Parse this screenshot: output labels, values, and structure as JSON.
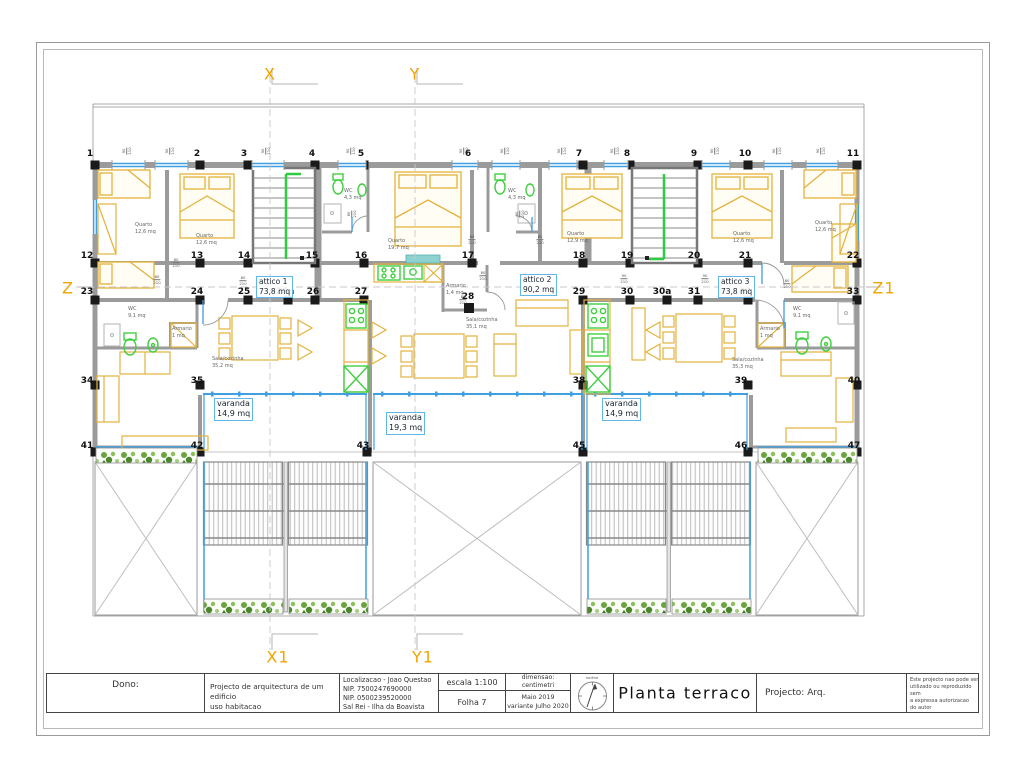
{
  "title_block": {
    "dono_label": "Dono:",
    "project_description": "Projecto de arquitectura de um edificio\nuso habitacao",
    "localizacao": "Localizacao - Joao Questao\nNIP. 7500247690000\nNIP. 0500239520000\nSal Rei - Ilha da Boavista",
    "escala": "escala 1:100",
    "folha": "Folha 7",
    "dimensao": "dimensao: centimetri",
    "data_variante": "Maio  2019\nvariante Julho  2020",
    "north_label": "northe",
    "drawing_title": "Planta terraco",
    "projecto": "Projecto:  Arq.",
    "nota": "Este projecto nao pode ser\nutilizado ou reproduzido  sem\na expressa autorizacao\ndo autor"
  },
  "colors": {
    "axis_accent": "#f0a500",
    "furniture_yellow": "#e3b23c",
    "fixture_green": "#3fcf3f",
    "glazing_blue": "#3f9fe0",
    "label_box_border": "#5fb6e8",
    "wall_gray": "#9b9b9b",
    "stair_rail_green": "#2ecc40"
  },
  "plan": {
    "axis_labels": [
      {
        "label": "X",
        "x": 270,
        "y": 74
      },
      {
        "label": "Y",
        "x": 415,
        "y": 74
      },
      {
        "label": "X1",
        "x": 278,
        "y": 657
      },
      {
        "label": "Y1",
        "x": 423,
        "y": 657
      },
      {
        "label": "Z",
        "x": 68,
        "y": 288
      },
      {
        "label": "Z1",
        "x": 884,
        "y": 288
      }
    ],
    "grid_labels": [
      {
        "t": "1",
        "x": 90,
        "y": 154
      },
      {
        "t": "2",
        "x": 197,
        "y": 154
      },
      {
        "t": "3",
        "x": 244,
        "y": 154
      },
      {
        "t": "4",
        "x": 312,
        "y": 154
      },
      {
        "t": "5",
        "x": 361,
        "y": 154
      },
      {
        "t": "6",
        "x": 468,
        "y": 154
      },
      {
        "t": "7",
        "x": 579,
        "y": 154
      },
      {
        "t": "8",
        "x": 627,
        "y": 154
      },
      {
        "t": "9",
        "x": 694,
        "y": 154
      },
      {
        "t": "10",
        "x": 745,
        "y": 154
      },
      {
        "t": "11",
        "x": 853,
        "y": 154
      },
      {
        "t": "12",
        "x": 87,
        "y": 256
      },
      {
        "t": "13",
        "x": 197,
        "y": 256
      },
      {
        "t": "14",
        "x": 244,
        "y": 256
      },
      {
        "t": "15",
        "x": 312,
        "y": 256
      },
      {
        "t": "16",
        "x": 361,
        "y": 256
      },
      {
        "t": "17",
        "x": 468,
        "y": 256
      },
      {
        "t": "18",
        "x": 579,
        "y": 256
      },
      {
        "t": "19",
        "x": 627,
        "y": 256
      },
      {
        "t": "20",
        "x": 694,
        "y": 256
      },
      {
        "t": "21",
        "x": 745,
        "y": 256
      },
      {
        "t": "22",
        "x": 853,
        "y": 256
      },
      {
        "t": "23",
        "x": 87,
        "y": 292
      },
      {
        "t": "24",
        "x": 197,
        "y": 292
      },
      {
        "t": "25",
        "x": 244,
        "y": 292
      },
      {
        "t": "25a",
        "x": 285,
        "y": 292
      },
      {
        "t": "26",
        "x": 313,
        "y": 292
      },
      {
        "t": "27",
        "x": 361,
        "y": 292
      },
      {
        "t": "28",
        "x": 468,
        "y": 297
      },
      {
        "t": "29",
        "x": 579,
        "y": 292
      },
      {
        "t": "30",
        "x": 627,
        "y": 292
      },
      {
        "t": "30a",
        "x": 662,
        "y": 292
      },
      {
        "t": "31",
        "x": 694,
        "y": 292
      },
      {
        "t": "32",
        "x": 745,
        "y": 292
      },
      {
        "t": "33",
        "x": 853,
        "y": 292
      },
      {
        "t": "34",
        "x": 87,
        "y": 381
      },
      {
        "t": "35",
        "x": 197,
        "y": 381
      },
      {
        "t": "38",
        "x": 579,
        "y": 381
      },
      {
        "t": "39",
        "x": 741,
        "y": 381
      },
      {
        "t": "40",
        "x": 854,
        "y": 381
      },
      {
        "t": "41",
        "x": 87,
        "y": 446
      },
      {
        "t": "42",
        "x": 197,
        "y": 446
      },
      {
        "t": "43",
        "x": 363,
        "y": 446
      },
      {
        "t": "45",
        "x": 579,
        "y": 446
      },
      {
        "t": "46",
        "x": 741,
        "y": 446
      },
      {
        "t": "47",
        "x": 854,
        "y": 446
      }
    ],
    "room_labels": [
      {
        "t": "Quarto\n12,6 mq",
        "x": 135,
        "y": 222
      },
      {
        "t": "Quarto\n12,6 mq",
        "x": 196,
        "y": 233
      },
      {
        "t": "WC\n4,3 mq",
        "x": 344,
        "y": 188
      },
      {
        "t": "Quarto\n19,7 mq",
        "x": 388,
        "y": 238
      },
      {
        "t": "WC\n4,3 mq",
        "x": 508,
        "y": 188
      },
      {
        "t": "Quarto\n12,9 mq",
        "x": 567,
        "y": 231
      },
      {
        "t": "Quarto\n12,6 mq",
        "x": 733,
        "y": 231
      },
      {
        "t": "Quarto\n12,6 mq",
        "x": 815,
        "y": 220
      },
      {
        "t": "WC\n9,1 mq",
        "x": 128,
        "y": 306
      },
      {
        "t": "Armario\n1 mq",
        "x": 172,
        "y": 326
      },
      {
        "t": "Sala/cozinha\n35,2 mq",
        "x": 212,
        "y": 356
      },
      {
        "t": "Armario\n1,4 mq",
        "x": 446,
        "y": 283
      },
      {
        "t": "Sala/cozinha\n35,1 mq",
        "x": 466,
        "y": 317
      },
      {
        "t": "Armario\n1 mq",
        "x": 760,
        "y": 326
      },
      {
        "t": "WC\n9,1 mq",
        "x": 793,
        "y": 306
      },
      {
        "t": "Sala/cozinha\n35,3 mq",
        "x": 732,
        "y": 357
      }
    ],
    "area_boxes": [
      {
        "t1": "attico 1",
        "t2": "73,8 mq",
        "x": 256,
        "y": 276,
        "cls": "attico"
      },
      {
        "t1": "attico 2",
        "t2": "90,2 mq",
        "x": 520,
        "y": 274,
        "cls": "attico"
      },
      {
        "t1": "attico 3",
        "t2": "73,8 mq",
        "x": 718,
        "y": 276,
        "cls": "attico"
      },
      {
        "t1": "varanda",
        "t2": "14,9 mq",
        "x": 214,
        "y": 398,
        "cls": "varanda"
      },
      {
        "t1": "varanda",
        "t2": "19,3 mq",
        "x": 386,
        "y": 412,
        "cls": "varanda"
      },
      {
        "t1": "varanda",
        "t2": "14,9 mq",
        "x": 602,
        "y": 398,
        "cls": "varanda"
      }
    ],
    "dim_labels": [
      {
        "v": "80/210",
        "x": 176,
        "y": 263
      },
      {
        "v": "80/210",
        "x": 243,
        "y": 281
      },
      {
        "v": "80/210",
        "x": 157,
        "y": 280
      },
      {
        "v": "80/210",
        "x": 472,
        "y": 240
      },
      {
        "v": "80/210",
        "x": 483,
        "y": 276
      },
      {
        "v": "80/210",
        "x": 540,
        "y": 240
      },
      {
        "v": "90/210",
        "x": 624,
        "y": 279
      },
      {
        "v": "90/210",
        "x": 705,
        "y": 279
      },
      {
        "v": "80/210",
        "x": 787,
        "y": 284
      },
      {
        "v": "80/210",
        "x": 352,
        "y": 214,
        "r": 1
      },
      {
        "v": "80/210",
        "x": 520,
        "y": 214,
        "r": 1
      },
      {
        "v": "80/210",
        "x": 463,
        "y": 300
      }
    ],
    "window_dims": [
      {
        "v": "90/110",
        "x": 127,
        "y": 151
      },
      {
        "v": "90/110",
        "x": 170,
        "y": 151
      },
      {
        "v": "90/110",
        "x": 266,
        "y": 151
      },
      {
        "v": "90/110",
        "x": 351,
        "y": 151
      },
      {
        "v": "90/110",
        "x": 464,
        "y": 151
      },
      {
        "v": "90/110",
        "x": 505,
        "y": 151
      },
      {
        "v": "90/110",
        "x": 562,
        "y": 151
      },
      {
        "v": "90/110",
        "x": 615,
        "y": 151
      },
      {
        "v": "90/110",
        "x": 715,
        "y": 151
      },
      {
        "v": "90/110",
        "x": 777,
        "y": 151
      },
      {
        "v": "90/110",
        "x": 821,
        "y": 151
      }
    ]
  }
}
